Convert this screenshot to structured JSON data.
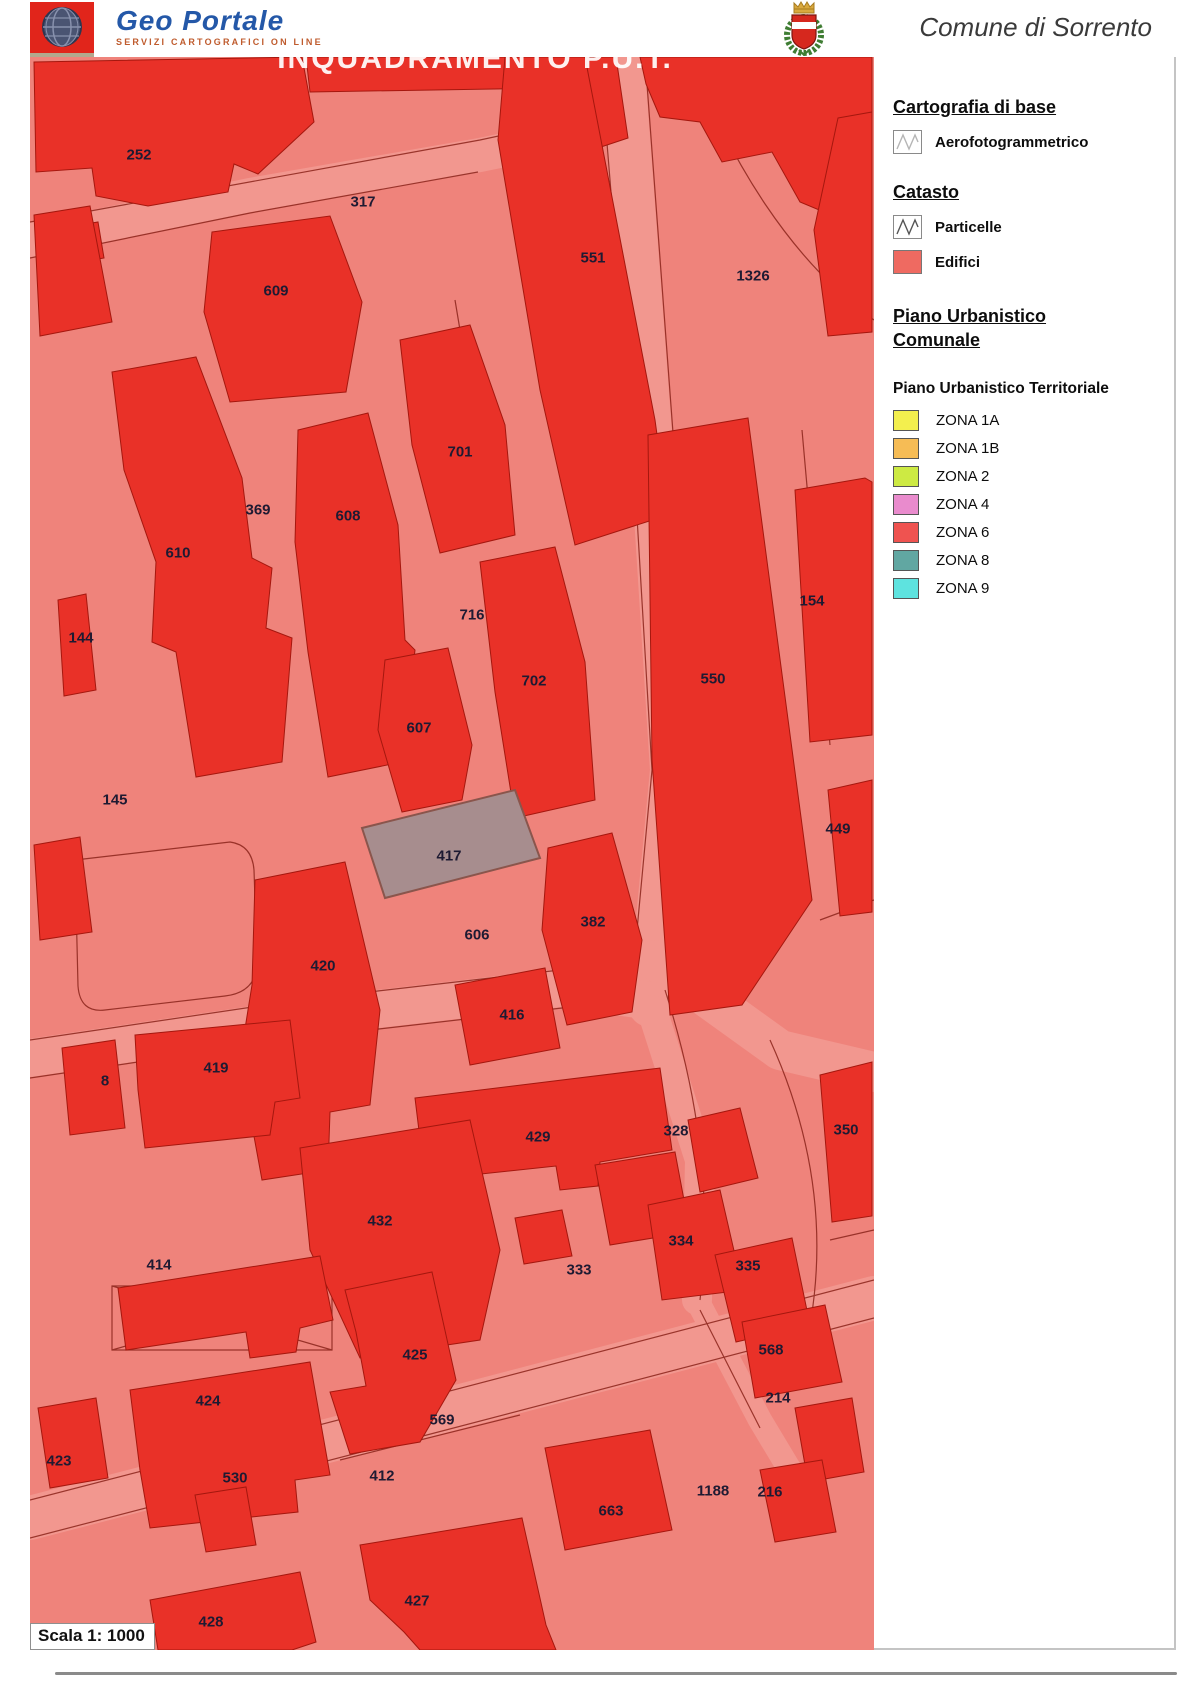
{
  "header": {
    "brand_title": "Geo Portale",
    "brand_subtitle": "SERVIZI CARTOGRAFICI ON LINE",
    "municipality": "Comune di Sorrento"
  },
  "map": {
    "title_overlay": "INQUADRAMENTO P.U.T.",
    "scale_label": "Scala 1: 1000",
    "selected_parcel": "417",
    "colors": {
      "background": "#ef837b",
      "building": "#e93128",
      "building_outline": "#a5170e",
      "parcel_line": "#8b241b",
      "road": "#f2978f",
      "selected_parcel_fill": "#a78d8e",
      "selected_parcel_stroke": "#8a554c",
      "label_text": "#1e1a32"
    },
    "parcel_labels": [
      {
        "t": "252",
        "x": 139,
        "y": 155
      },
      {
        "t": "317",
        "x": 363,
        "y": 202
      },
      {
        "t": "551",
        "x": 593,
        "y": 258
      },
      {
        "t": "1326",
        "x": 753,
        "y": 276
      },
      {
        "t": "609",
        "x": 276,
        "y": 291
      },
      {
        "t": "701",
        "x": 460,
        "y": 452
      },
      {
        "t": "369",
        "x": 258,
        "y": 510
      },
      {
        "t": "608",
        "x": 348,
        "y": 516
      },
      {
        "t": "610",
        "x": 178,
        "y": 553
      },
      {
        "t": "716",
        "x": 472,
        "y": 615
      },
      {
        "t": "154",
        "x": 812,
        "y": 601
      },
      {
        "t": "144",
        "x": 81,
        "y": 638
      },
      {
        "t": "702",
        "x": 534,
        "y": 681
      },
      {
        "t": "550",
        "x": 713,
        "y": 679
      },
      {
        "t": "607",
        "x": 419,
        "y": 728
      },
      {
        "t": "145",
        "x": 115,
        "y": 800
      },
      {
        "t": "449",
        "x": 838,
        "y": 829
      },
      {
        "t": "417",
        "x": 449,
        "y": 856
      },
      {
        "t": "606",
        "x": 477,
        "y": 935
      },
      {
        "t": "382",
        "x": 593,
        "y": 922
      },
      {
        "t": "420",
        "x": 323,
        "y": 966
      },
      {
        "t": "416",
        "x": 512,
        "y": 1015
      },
      {
        "t": "419",
        "x": 216,
        "y": 1068
      },
      {
        "t": "8",
        "x": 105,
        "y": 1081
      },
      {
        "t": "429",
        "x": 538,
        "y": 1137
      },
      {
        "t": "328",
        "x": 676,
        "y": 1131
      },
      {
        "t": "350",
        "x": 846,
        "y": 1130
      },
      {
        "t": "432",
        "x": 380,
        "y": 1221
      },
      {
        "t": "334",
        "x": 681,
        "y": 1241
      },
      {
        "t": "414",
        "x": 159,
        "y": 1265
      },
      {
        "t": "333",
        "x": 579,
        "y": 1270
      },
      {
        "t": "335",
        "x": 748,
        "y": 1266
      },
      {
        "t": "568",
        "x": 771,
        "y": 1350
      },
      {
        "t": "425",
        "x": 415,
        "y": 1355
      },
      {
        "t": "424",
        "x": 208,
        "y": 1401
      },
      {
        "t": "214",
        "x": 778,
        "y": 1398
      },
      {
        "t": "569",
        "x": 442,
        "y": 1420
      },
      {
        "t": "423",
        "x": 59,
        "y": 1461
      },
      {
        "t": "530",
        "x": 235,
        "y": 1478
      },
      {
        "t": "412",
        "x": 382,
        "y": 1476
      },
      {
        "t": "1188",
        "x": 713,
        "y": 1491
      },
      {
        "t": "216",
        "x": 770,
        "y": 1492
      },
      {
        "t": "663",
        "x": 611,
        "y": 1511
      },
      {
        "t": "427",
        "x": 417,
        "y": 1601
      },
      {
        "t": "428",
        "x": 211,
        "y": 1622
      }
    ]
  },
  "legend": {
    "sections": [
      {
        "title": "Cartografia di base",
        "items": [
          {
            "label": "Aerofotogrammetrico",
            "swatch": "zigzag-light"
          }
        ]
      },
      {
        "title": "Catasto",
        "items": [
          {
            "label": "Particelle",
            "swatch": "zigzag"
          },
          {
            "label": "Edifici",
            "swatch": "#ef6a61"
          }
        ]
      },
      {
        "title": "Piano Urbanistico Comunale",
        "items": []
      }
    ],
    "put": {
      "title": "Piano Urbanistico Territoriale",
      "zones": [
        {
          "label": "ZONA 1A",
          "color": "#f3ef4e"
        },
        {
          "label": "ZONA 1B",
          "color": "#f6bc55"
        },
        {
          "label": "ZONA 2",
          "color": "#cdea43"
        },
        {
          "label": "ZONA 4",
          "color": "#e98bcd"
        },
        {
          "label": "ZONA 6",
          "color": "#ef5350"
        },
        {
          "label": "ZONA 8",
          "color": "#61a7a2"
        },
        {
          "label": "ZONA 9",
          "color": "#5ee3df"
        }
      ]
    }
  }
}
